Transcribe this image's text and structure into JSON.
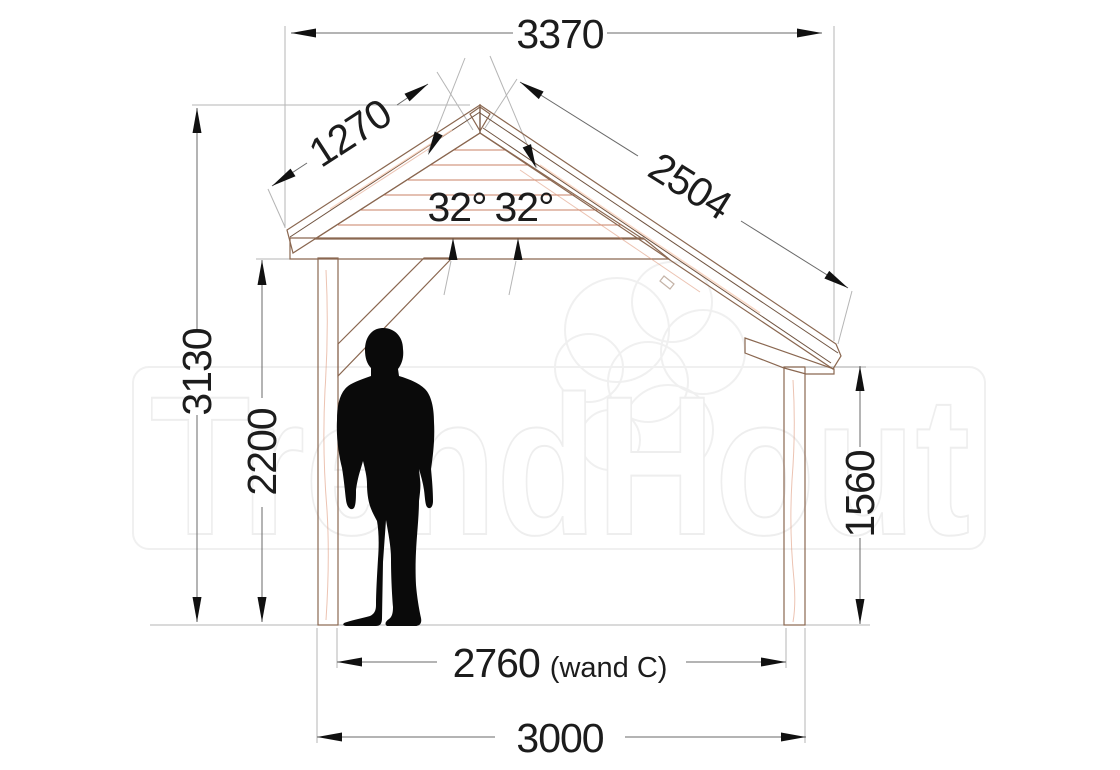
{
  "drawing": {
    "watermark_text": "TrendHout",
    "dims": {
      "top_width": "3370",
      "left_rafter": "1270",
      "right_rafter": "2504",
      "left_angle": "32°",
      "right_angle": "32°",
      "overall_height": "3130",
      "passage_height": "2200",
      "right_post_height": "1560",
      "inner_span": "2760",
      "inner_span_note": "(wand C)",
      "outer_span": "3000"
    },
    "colors": {
      "wood": "#f1a68a",
      "wood_deck": "#e99d7f",
      "wood_light": "#f6c3ab",
      "wood_beam": "#f3ac8e",
      "outline": "#8a6750",
      "dim_line": "#696969",
      "ext_line": "#b5b5b5",
      "text": "#1c1c1c",
      "person": "#0a0a0a",
      "watermark": "#eeeeee"
    }
  }
}
